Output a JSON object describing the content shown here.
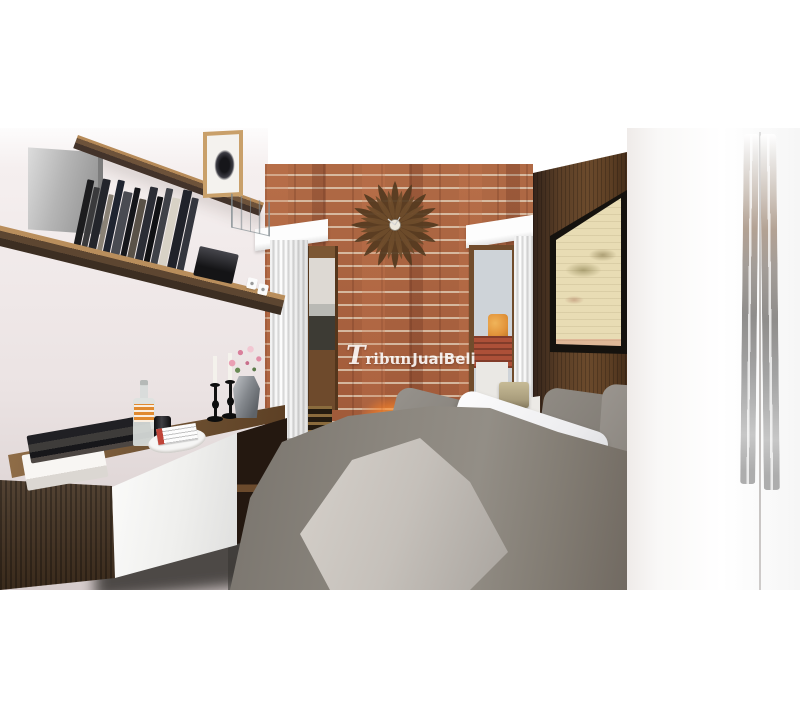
{
  "watermark": {
    "initial": "T",
    "serif_part": "ribun",
    "bold_part": "JualBeli",
    "full_text": "TribunJualBeli",
    "color": "#ffffff"
  },
  "scene": {
    "type": "3d-interior-render",
    "room": "bedroom",
    "palette": {
      "wall_pink_white": "#efe8e8",
      "brick": "#a5603f",
      "mortar": "#ddccb6",
      "accent_glow": "#ff9a33",
      "console_wood_dark": "#42301f",
      "shelf_wood": "#6d523a",
      "headboard_panel": "#5a3e26",
      "duvet_gray": "#878078",
      "linen_white": "#f4f4f5",
      "throw_gray": "#c9c4be",
      "wardrobe_white": "#fafaf9",
      "map_paper": "#e8dcb4",
      "window_sky": "#ced3d8",
      "water_tank_orange": "#e2933a",
      "roof_red": "#ad5038",
      "lamp_shade_khaki": "#b3a787"
    },
    "objects": [
      "floating-wall-shelves",
      "metal-tv-box",
      "row-of-books",
      "framed-art-print",
      "wire-magazine-rack",
      "black-radio",
      "wall-sockets",
      "floating-tv-console",
      "stacked-books",
      "glass-bottle",
      "black-can",
      "tray-with-magazine",
      "black-candlesticks",
      "white-candles",
      "faceted-vase",
      "pink-flowers",
      "brick-accent-wall",
      "sunburst-wall-clock",
      "accent-spotlight",
      "fluted-pilasters",
      "cornices",
      "left-window",
      "right-window-with-roof-view",
      "slatted-grille",
      "wood-headboard-panel",
      "framed-antique-map",
      "bed-with-gray-duvet",
      "white-pillows",
      "gray-pillows",
      "throw-blanket",
      "white-sheet",
      "bedside-lamp",
      "white-wardrobe",
      "chrome-wardrobe-handles"
    ]
  }
}
